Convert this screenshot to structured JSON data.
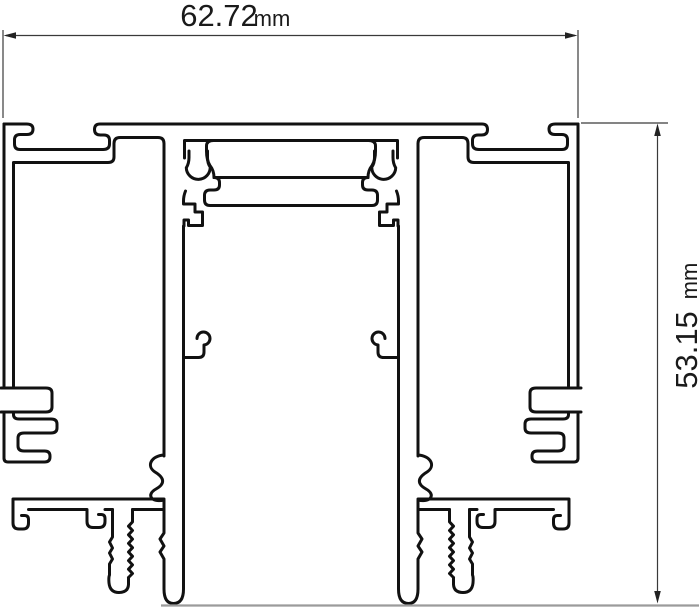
{
  "drawing": {
    "title": "aluminium-profile-cross-section",
    "width_dimension": {
      "value": "62.72",
      "unit": "mm"
    },
    "height_dimension": {
      "value": "53.15",
      "unit": "mm"
    },
    "colors": {
      "outline": "#111111",
      "dimension_lines": "#3a3a3a",
      "baseline": "#9b9b9b",
      "background": "#ffffff"
    }
  }
}
